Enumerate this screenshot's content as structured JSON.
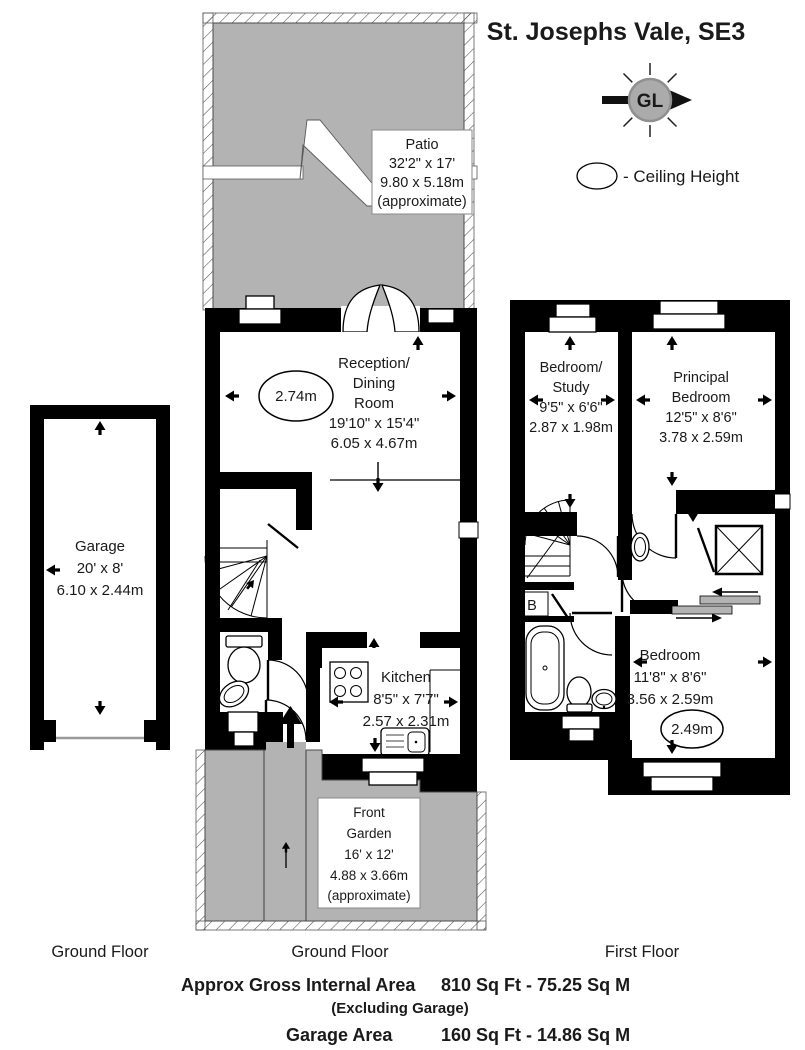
{
  "title": "St. Josephs Vale, SE3",
  "legend": {
    "compass": "GL",
    "ceiling": "- Ceiling Height"
  },
  "garage": {
    "floor_label": "Ground Floor",
    "name": "Garage",
    "imperial": "20' x 8'",
    "metric": "6.10 x 2.44m"
  },
  "ground": {
    "floor_label": "Ground Floor",
    "patio": {
      "name": "Patio",
      "imperial": "32'2\" x 17'",
      "metric": "9.80 x 5.18m",
      "note": "(approximate)"
    },
    "reception": {
      "l1": "Reception/",
      "l2": "Dining",
      "l3": "Room",
      "imperial": "19'10\" x 15'4\"",
      "metric": "6.05 x 4.67m",
      "ceiling": "2.74m"
    },
    "kitchen": {
      "name": "Kitchen",
      "imperial": "8'5\" x 7'7\"",
      "metric": "2.57 x 2.31m"
    },
    "garden": {
      "l1": "Front",
      "l2": "Garden",
      "imperial": "16' x 12'",
      "metric": "4.88 x 3.66m",
      "note": "(approximate)"
    }
  },
  "first": {
    "floor_label": "First Floor",
    "study": {
      "l1": "Bedroom/",
      "l2": "Study",
      "imperial": "9'5\" x 6'6\"",
      "metric": "2.87 x 1.98m"
    },
    "principal": {
      "l1": "Principal",
      "l2": "Bedroom",
      "imperial": "12'5\" x 8'6\"",
      "metric": "3.78 x 2.59m"
    },
    "bedroom": {
      "name": "Bedroom",
      "imperial": "11'8\" x 8'6\"",
      "metric": "3.56 x 2.59m",
      "ceiling": "2.49m"
    },
    "boiler": "B"
  },
  "footer": {
    "gia_label": "Approx Gross Internal Area",
    "gia_value": "810 Sq Ft - 75.25 Sq M",
    "gia_note": "(Excluding Garage)",
    "garage_label": "Garage Area",
    "garage_value": "160 Sq Ft - 14.86 Sq M"
  },
  "colors": {
    "outdoor": "#b3b3b3",
    "wall": "#000000",
    "compass_fill": "#ababab"
  }
}
